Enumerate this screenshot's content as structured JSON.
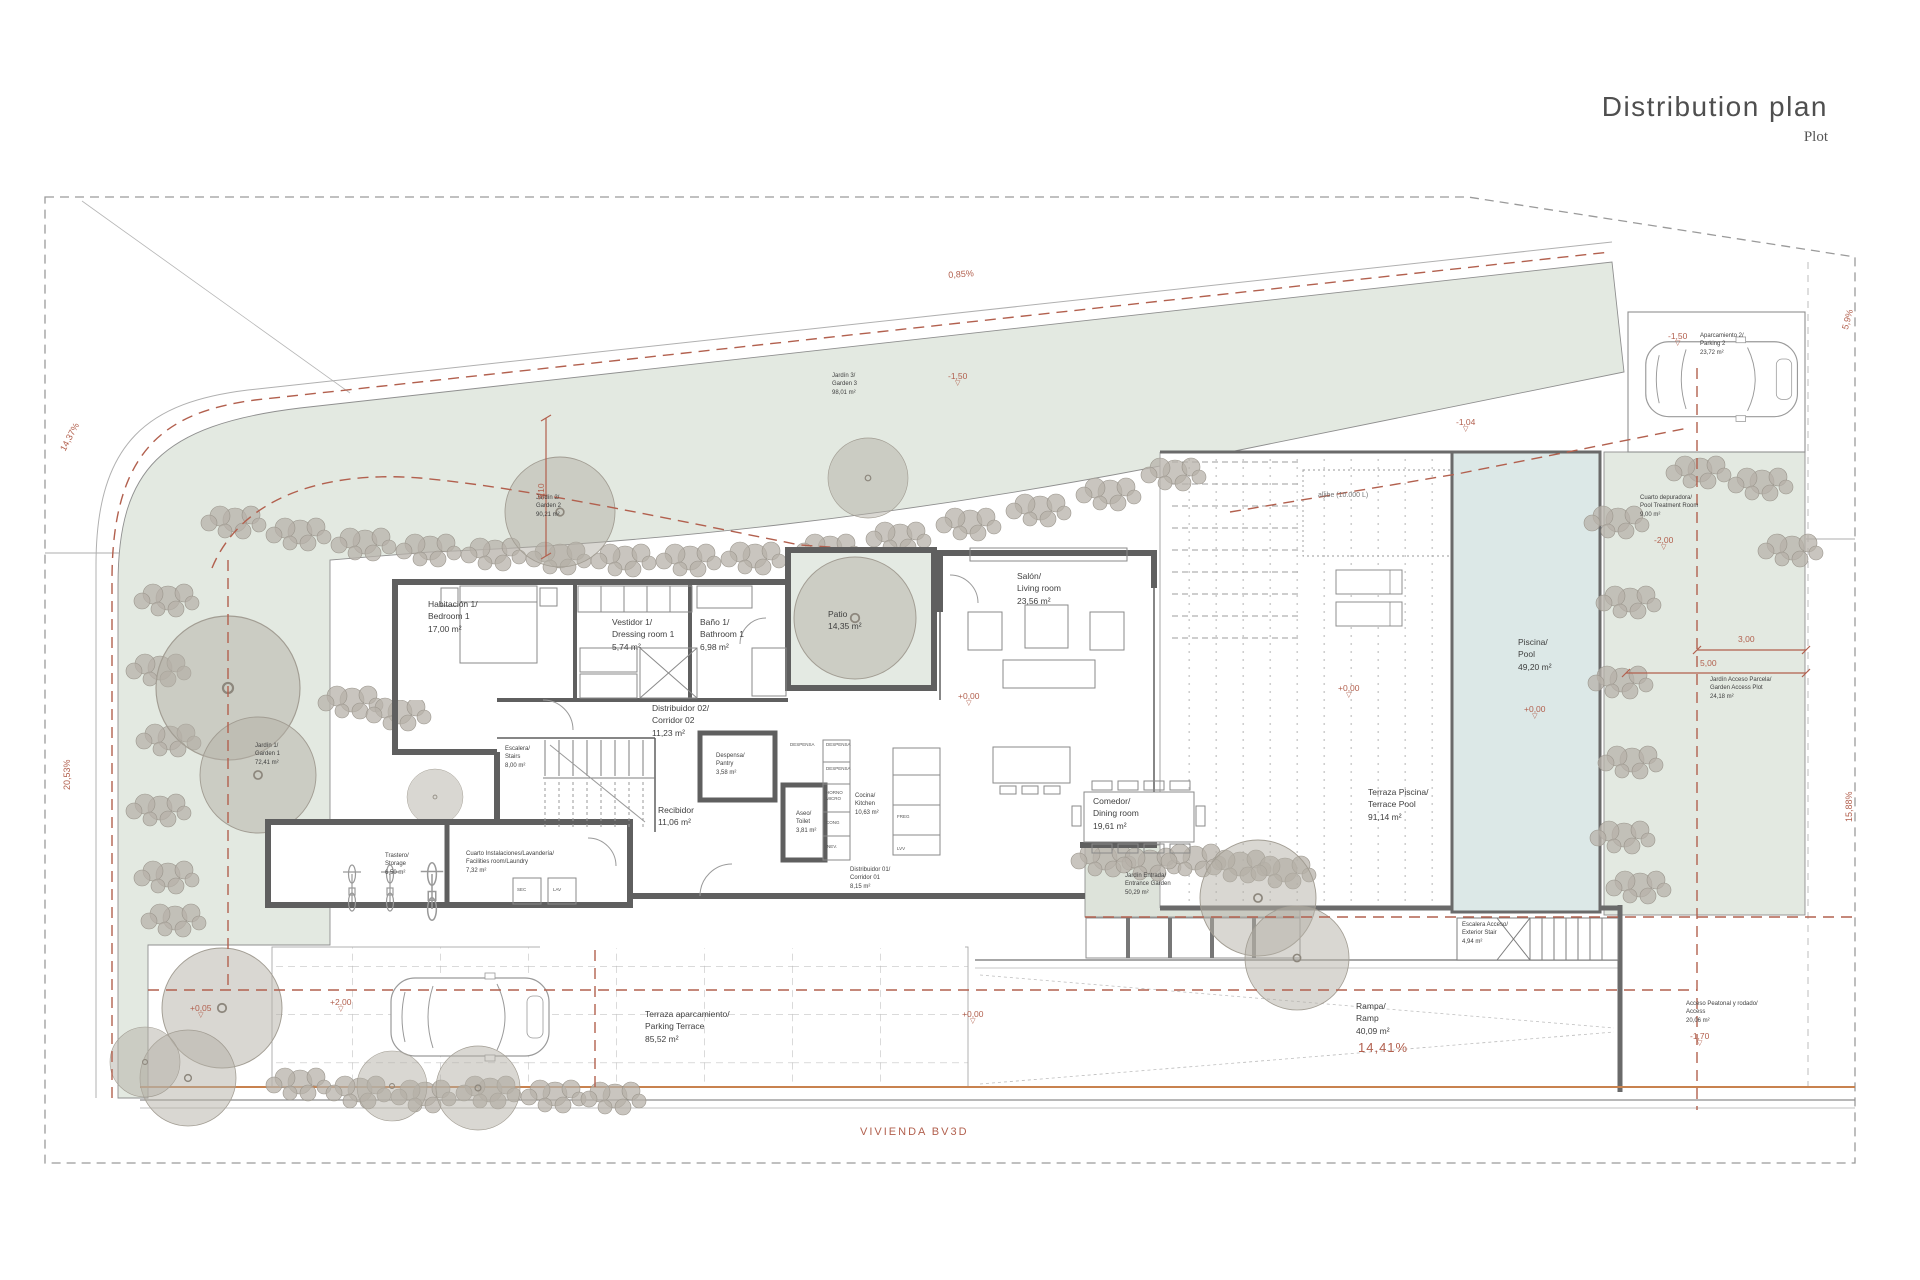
{
  "title": {
    "main": "Distribution plan",
    "subtitle": "Plot"
  },
  "site_label": "VIVIENDA BV3D",
  "colors": {
    "garden": "#e3e9e1",
    "pool": "#dce8e7",
    "wall": "#5f5f5f",
    "annotation_red": "#b2604e",
    "tree": "#b4afa6"
  },
  "rooms": {
    "bedroom1": {
      "l1": "Habitación 1/",
      "l2": "Bedroom 1",
      "l3": "17,00 m²"
    },
    "vestidor1": {
      "l1": "Vestidor 1/",
      "l2": "Dressing room 1",
      "l3": "5,74 m²"
    },
    "bano1": {
      "l1": "Baño 1/",
      "l2": "Bathroom 1",
      "l3": "6,98 m²"
    },
    "patio": {
      "l1": "Patio",
      "l3": "14,35 m²"
    },
    "salon": {
      "l1": "Salón/",
      "l2": "Living room",
      "l3": "23,56 m²"
    },
    "distribuidor02": {
      "l1": "Distribuidor 02/",
      "l2": "Corridor 02",
      "l3": "11,23 m²"
    },
    "escalera": {
      "l1": "Escalera/",
      "l2": "Stairs",
      "l3": "8,00 m²"
    },
    "despensa": {
      "l1": "Despensa/",
      "l2": "Pantry",
      "l3": "3,58 m²"
    },
    "recibidor": {
      "l1": "Recibidor",
      "l3": "11,06 m²"
    },
    "aseo": {
      "l1": "Aseo/",
      "l2": "Toilet",
      "l3": "3,81 m²"
    },
    "cocina": {
      "l1": "Cocina/",
      "l2": "Kitchen",
      "l3": "10,63 m²"
    },
    "distribuidor01": {
      "l1": "Distribuidor 01/",
      "l2": "Corridor 01",
      "l3": "8,15 m²"
    },
    "comedor": {
      "l1": "Comedor/",
      "l2": "Dining room",
      "l3": "19,61 m²"
    },
    "instalaciones": {
      "l1": "Cuarto Instalaciones/Lavandería/",
      "l2": "Facilities room/Laundry",
      "l3": "7,32 m²"
    },
    "trastero": {
      "l1": "Trastero/",
      "l2": "Storage",
      "l3": "6,50 m²"
    },
    "jardin1": {
      "l1": "Jardín 1/",
      "l2": "Garden 1",
      "l3": "72,41 m²"
    },
    "jardin2": {
      "l1": "Jardín 2/",
      "l2": "Garden 2",
      "l3": "90,21 m²"
    },
    "jardin3": {
      "l1": "Jardín 3/",
      "l2": "Garden 3",
      "l3": "98,01 m²"
    },
    "jardin_entrada": {
      "l1": "Jardín Entrada/",
      "l2": "Entrance Garden",
      "l3": "50,29 m²"
    },
    "terraza_piscina": {
      "l1": "Terraza Piscina/",
      "l2": "Terrace Pool",
      "l3": "91,14 m²"
    },
    "piscina": {
      "l1": "Piscina/",
      "l2": "Pool",
      "l3": "49,20 m²"
    },
    "depuradora": {
      "l1": "Cuarto depuradora/",
      "l2": "Pool Treatment Room",
      "l3": "9,00 m²"
    },
    "jardin_acceso": {
      "l1": "Jardín Acceso Parcela/",
      "l2": "Garden Access Plot",
      "l3": "24,18 m²"
    },
    "aparcamiento2": {
      "l1": "Aparcamiento 2/",
      "l2": "Parking 2",
      "l3": "23,72 m²"
    },
    "terraza_aparc": {
      "l1": "Terraza aparcamiento/",
      "l2": "Parking Terrace",
      "l3": "85,52 m²"
    },
    "escalera_acceso": {
      "l1": "Escalera Acceso/",
      "l2": "Exterior Stair",
      "l3": "4,94 m²"
    },
    "rampa": {
      "l1": "Rampa/",
      "l2": "Ramp",
      "l3": "40,09 m²"
    },
    "acceso": {
      "l1": "Acceso Peatonal y rodado/",
      "l2": "Access",
      "l3": "20,06 m²"
    }
  },
  "fixtures": {
    "aljibe": "aljibe  (10.000 L)",
    "sec": "SEC",
    "lav": "LAV",
    "despensa": "DESPENSA",
    "horno": "HORNO",
    "micro": "MICRO",
    "cong": "CONG",
    "nev": "NEV.",
    "freg": "FREG",
    "lvv": "LVV"
  },
  "annotations": {
    "slopes": {
      "top": "0,85%",
      "left_upper": "14,37%",
      "left_lower": "20,53%",
      "right_upper": "5,9%",
      "right_lower": "15,88%",
      "ramp": "14,41%"
    },
    "dims": {
      "d310": "3,10",
      "d300": "3,00",
      "d500": "5,00"
    },
    "levels": {
      "zero": "+0,00",
      "plus005": "+0,05",
      "plus200": "+2,00",
      "minus150": "-1,50",
      "minus200": "-2,00",
      "minus170": "-1,70",
      "minus104": "-1,04"
    },
    "level_icon": "▽"
  }
}
